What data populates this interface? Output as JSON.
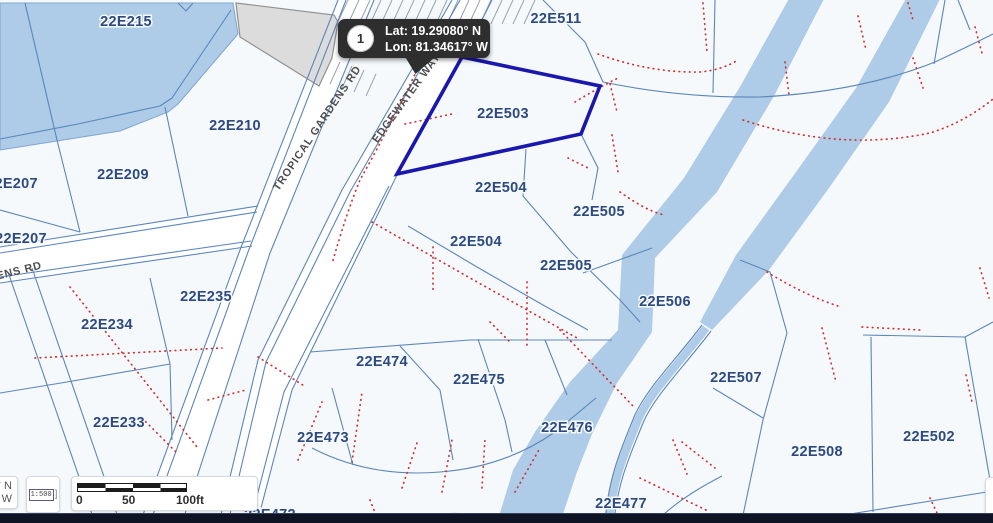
{
  "map": {
    "highlight_parcel": "22E503",
    "parcel_labels": [
      {
        "text": "22E215",
        "x": 126,
        "y": 26
      },
      {
        "text": "22E511",
        "x": 556,
        "y": 23
      },
      {
        "text": "22E210",
        "x": 235,
        "y": 130
      },
      {
        "text": "22E209",
        "x": 123,
        "y": 179
      },
      {
        "text": "22E207",
        "x": 12,
        "y": 188
      },
      {
        "text": "22E207",
        "x": 21,
        "y": 243
      },
      {
        "text": "22E235",
        "x": 206,
        "y": 301
      },
      {
        "text": "22E234",
        "x": 107,
        "y": 329
      },
      {
        "text": "22E233",
        "x": 119,
        "y": 427
      },
      {
        "text": "22E503",
        "x": 503,
        "y": 118
      },
      {
        "text": "22E504",
        "x": 501,
        "y": 192
      },
      {
        "text": "22E505",
        "x": 599,
        "y": 216
      },
      {
        "text": "22E504",
        "x": 476,
        "y": 246
      },
      {
        "text": "22E505",
        "x": 566,
        "y": 270
      },
      {
        "text": "22E506",
        "x": 665,
        "y": 306
      },
      {
        "text": "22E474",
        "x": 382,
        "y": 366
      },
      {
        "text": "22E475",
        "x": 479,
        "y": 384
      },
      {
        "text": "22E507",
        "x": 736,
        "y": 382
      },
      {
        "text": "22E473",
        "x": 323,
        "y": 442
      },
      {
        "text": "22E476",
        "x": 567,
        "y": 432
      },
      {
        "text": "22E508",
        "x": 817,
        "y": 456
      },
      {
        "text": "22E502",
        "x": 929,
        "y": 441
      },
      {
        "text": "22E477",
        "x": 621,
        "y": 508
      },
      {
        "text": "22E472",
        "x": 270,
        "y": 519
      }
    ],
    "road_labels": [
      {
        "text": "TROPICAL GARDENS RD",
        "x": 320,
        "y": 130,
        "rotate": -56
      },
      {
        "text": "EDGEWATER WAY",
        "x": 409,
        "y": 100,
        "rotate": -54
      },
      {
        "text": "ENS RD",
        "x": 20,
        "y": 274,
        "rotate": -14
      }
    ],
    "colors": {
      "background": "#f6f9fb",
      "water": "#aecbe7",
      "water_edge": "#7fa6d2",
      "line": "#5b86ba",
      "red": "#cf3333",
      "highlight": "#1a17ae",
      "label": "#2c4a80",
      "road_label": "#4f4f4f",
      "gray_fill": "#dcdcdc",
      "gray_edge": "#909090",
      "callout_bg": "#2e2e2e",
      "bottom_bar": "#0e1424"
    }
  },
  "callout": {
    "marker": "1",
    "lat": "Lat: 19.29080° N",
    "lon": "Lon: 81.34617° W"
  },
  "controls": {
    "coords_partial_line1": "° N",
    "coords_partial_line2": "W",
    "scale_ratio": "1:500",
    "scale_bar": {
      "start": "0",
      "mid": "50",
      "end": "100ft"
    }
  }
}
